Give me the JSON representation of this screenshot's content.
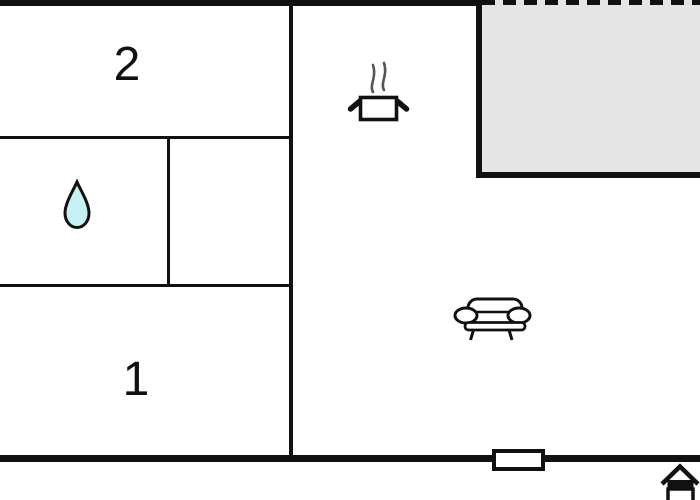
{
  "plan_type": "floor-plan",
  "colors": {
    "wall": "#111111",
    "terrace_fill": "#e5e5e6",
    "water_drop_fill": "#c5f0f4",
    "steam": "#555555",
    "icon_fill": "#ffffff",
    "background": "#ffffff"
  },
  "rooms": {
    "bedroom2": {
      "label": "2"
    },
    "bedroom1": {
      "label": "1"
    },
    "bathroom": {
      "icon": "water-drop-icon"
    },
    "kitchen": {
      "icon": "cooking-pot-icon"
    },
    "living": {
      "icon": "sofa-icon"
    },
    "terrace": {
      "edge": "dashed-open-boundary"
    }
  },
  "markers": {
    "window": "window-marker",
    "logo": "house-icon"
  }
}
